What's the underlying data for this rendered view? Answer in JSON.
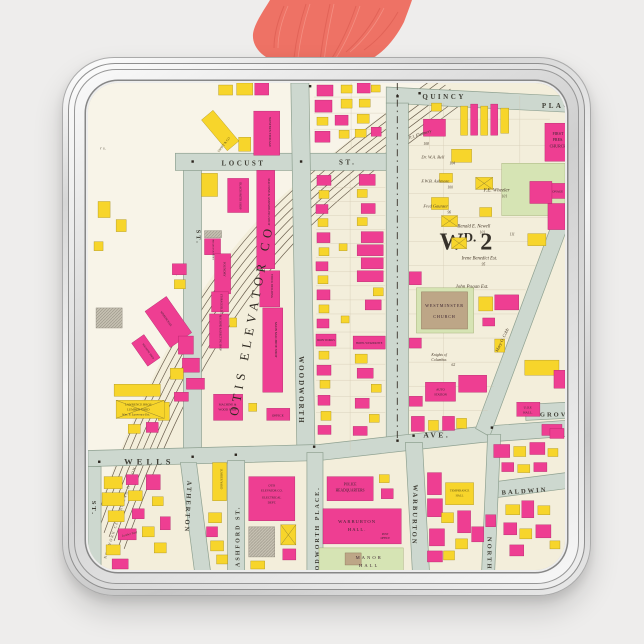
{
  "product": {
    "type": "square metal ornament photo",
    "background_color": "#eeedec",
    "frame_color": "#d6d6d6",
    "ribbon_color": "#ee7265"
  },
  "map": {
    "palette": {
      "paper": "#f3eedb",
      "paper_light": "#f8f4e8",
      "street": "#cdd8cf",
      "building_pink": "#ee3e92",
      "building_yellow": "#f7d52b",
      "lot_green": "#d6e4b4",
      "building_tan": "#bda687",
      "ink": "#3b342a"
    },
    "ward": {
      "w": "W",
      "d": "D.",
      "n": "2"
    },
    "streets": {
      "quincy": "QUINCY",
      "quincy_place": "PLACE",
      "locust": "LOCUST",
      "locust_st": "ST.",
      "wells": "WELLS",
      "wells_ave": "AVE.",
      "left_st": "ST.",
      "far_left_st": "ST.",
      "woodworth": "WOODWORTH",
      "atherton": "ATHERTON",
      "ashford": "ASHFORD ST.",
      "woodworth_place": "WOODWORTH PLACE.",
      "warburton": "WARBURTON",
      "north": "NORTH",
      "baldwin": "BALDWIN",
      "grove": "GROVE",
      "rr1": "NEW YORK CENTRAL AND HUDSON RIVER",
      "rr2": "RAIL ROAD"
    },
    "owners": {
      "flannery": {
        "name": "P.J. Flannery",
        "num": "108"
      },
      "bell": {
        "name": "Dr. W.A. Bell",
        "num": "104"
      },
      "ashmore": {
        "name": "F.W.B. Ashmore",
        "num": "100"
      },
      "gaunzer": {
        "name": "Fred Gaunzer",
        "num": "96"
      },
      "wheeler": {
        "name": "F.E. Wheeler",
        "num": "101"
      },
      "newell": {
        "name": "Renald E. Newell",
        "num": "101"
      },
      "benedict": {
        "name": "Irene Benedict Est.",
        "num": "95"
      },
      "pagan": {
        "name": "John Pagan Est.",
        "num": "85"
      },
      "cobb": {
        "name": "Mary O. Cobb"
      },
      "columbus": {
        "l1": "Knights of",
        "l2": "Columbus",
        "num": "62"
      },
      "lawrence_est": "Wm. F. Lawrence Est.",
      "rs": "r s.",
      "n111": "111"
    },
    "buildings": {
      "swift": "SWIFT & CO",
      "western": "WESTERN STORAGE",
      "blacksmith": "BLACKSMITH SHOP",
      "assembling": "MACHINE & ASSEMBLING SHOP",
      "brass": "BRASS FOUNDRY",
      "foundry": "FOUNDRY",
      "storage": "STORAGE BLDG.",
      "stock": "STOCK BUILDING",
      "erecting": "MACHINE & ERECTING SHOP",
      "main_machine": "MAIN MACHINE SHOP",
      "wood1": "MACHINE &",
      "wood2": "WOOD SHOP",
      "office": "OFFICE",
      "otis_big": "OTIS ELEVATOR CO",
      "iron_works": "IRON WORKS",
      "hotel": "HOTEL WYANDOTTE",
      "first_pres": [
        "FIRST",
        "PRES.",
        "CHURCH"
      ],
      "parsonage": "PARSONAGE",
      "westminster": [
        "WESTMINSTER",
        "CHURCH"
      ],
      "auto": [
        "AUTO",
        "STATION"
      ],
      "uof": [
        "U.O.F.",
        "HALL."
      ],
      "temperance": [
        "TEMPERANCE",
        "HALL"
      ],
      "police": [
        "POLICE",
        "HEADQUARTERS"
      ],
      "warburton_hall": [
        "WARBURTON",
        "HALL."
      ],
      "post_office": [
        "POST",
        "OFFICE"
      ],
      "manor": [
        "MANOR",
        "HALL"
      ],
      "otis_elec": [
        "OTIS",
        "ELEVATOR CO.",
        "ELECTRICAL",
        "DEPT."
      ],
      "lumber_yard": "LUMBER YARD",
      "lawrence": [
        "LAWRENCE BROS",
        "LUMBER YARD"
      ],
      "warehouse": "WAREHOUSE",
      "machine_shop": "MACHINE SHOP",
      "lumber_yard2": "Lumber Yard"
    }
  }
}
